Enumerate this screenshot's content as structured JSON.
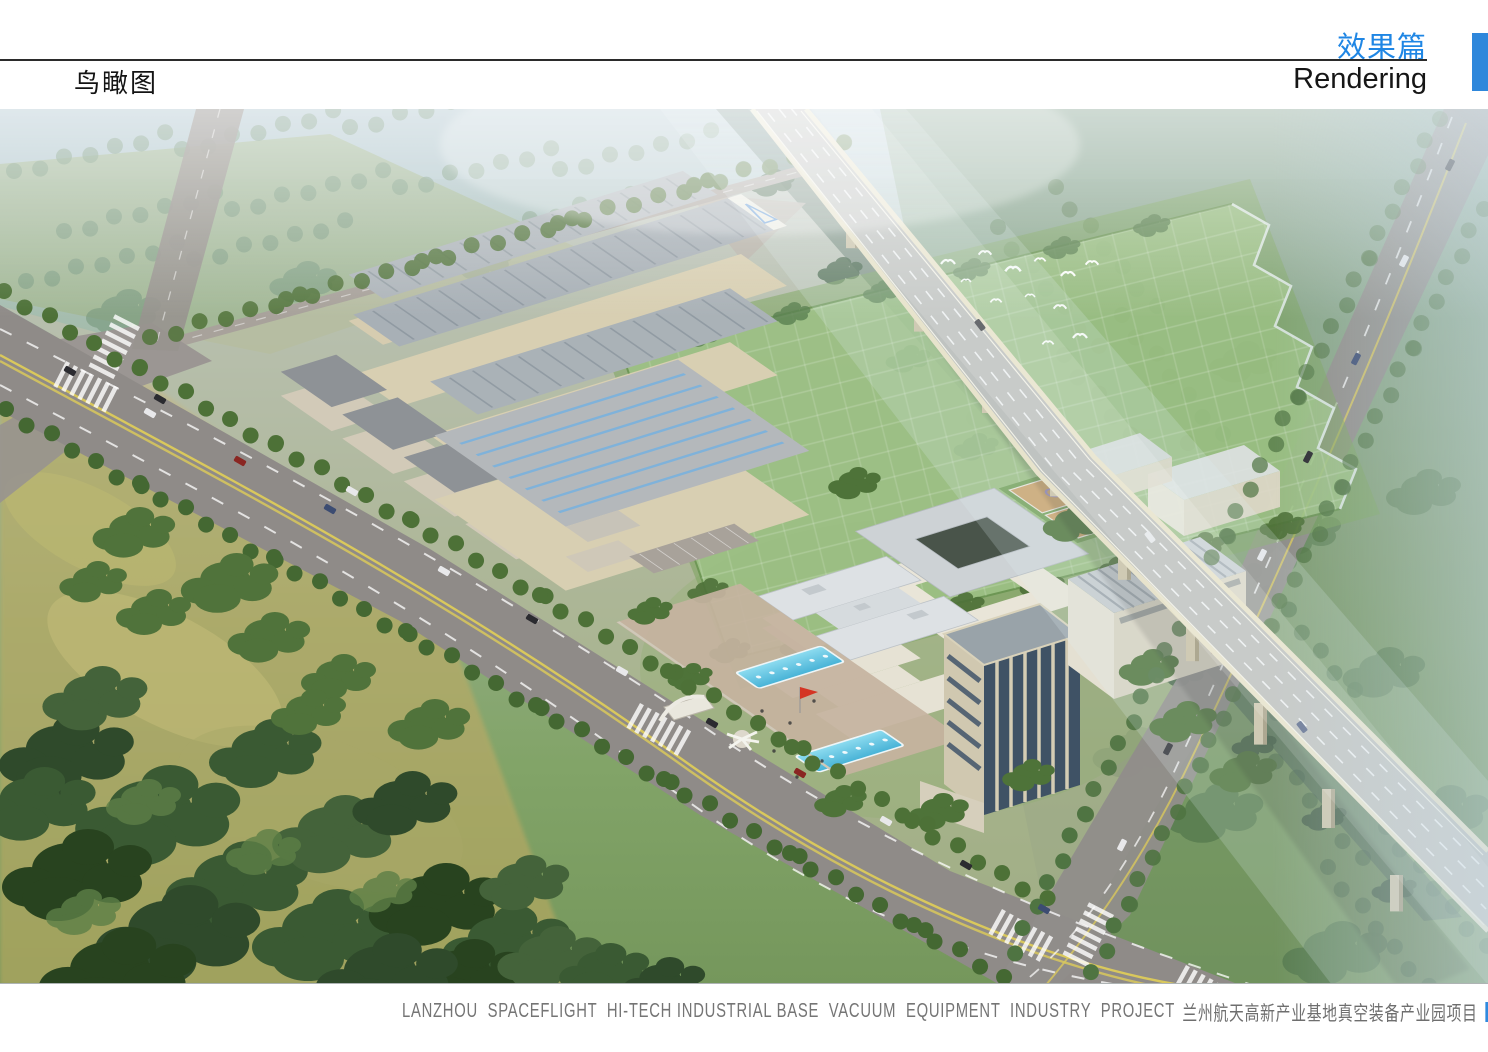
{
  "header": {
    "page_title": "鸟瞰图",
    "section_title_zh": "效果篇",
    "section_title_en": "Rendering",
    "accent_color": "#2e87db"
  },
  "footer": {
    "caption_en": "LANZHOU  SPACEFLIGHT  HI-TECH INDUSTRIAL BASE  VACUUM  EQUIPMENT  INDUSTRY  PROJECT",
    "caption_zh": "兰州航天高新产业基地真空装备产业园项目",
    "marker_color": "#2f8ade"
  },
  "rendering": {
    "type": "aerial-birdseye-rendering",
    "key_colors": {
      "field_green": "#9ec487",
      "pool_blue": "#5ec0e0",
      "roof_gray": "#a8b0b6",
      "wall_cream": "#d8cfb2",
      "forest_dark": "#3a5a33",
      "road_gray": "#8f8b88",
      "flag_red": "#d43524"
    }
  }
}
